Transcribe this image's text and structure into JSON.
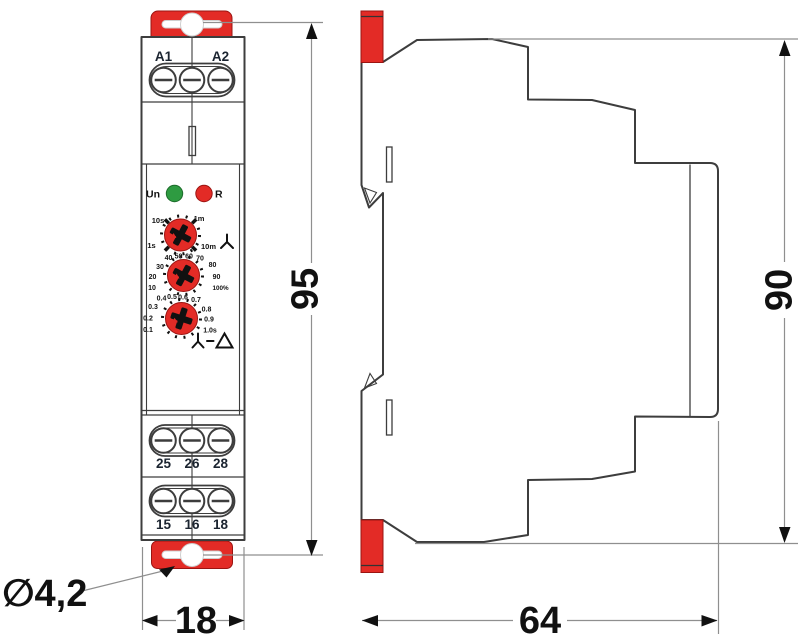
{
  "front_view": {
    "top_terminals": {
      "labels": [
        "A1",
        "A2"
      ]
    },
    "leds": {
      "un": "Un",
      "r": "R"
    },
    "dial_time_range": {
      "scale": [
        "10s",
        "1m",
        "1s",
        "10m"
      ]
    },
    "dial_percent": {
      "scale": [
        "10",
        "20",
        "30",
        "40",
        "50",
        "60",
        "70",
        "80",
        "90",
        "100%"
      ]
    },
    "dial_seconds": {
      "scale": [
        "0.1",
        "0.2",
        "0.3",
        "0.4",
        "0.5",
        "0.6",
        "0.7",
        "0.8",
        "0.9",
        "1.0s"
      ]
    },
    "relay_terminals_row1": [
      "25",
      "26",
      "28"
    ],
    "relay_terminals_row2": [
      "15",
      "16",
      "18"
    ]
  },
  "dimensions": {
    "front_height": "95",
    "front_width": "18",
    "side_height": "90",
    "side_depth": "64",
    "mounting_hole_diameter": "∅4,2"
  },
  "icons": {
    "star": "star-icon (Y phase symbol)",
    "star_delta": "star-delta-icon (Y–Δ symbol)"
  },
  "colors": {
    "red": "#e32b26",
    "green": "#2e9b41",
    "label": "#1b2430",
    "line": "#3d3d3d",
    "dim": "#8f8f8f"
  }
}
